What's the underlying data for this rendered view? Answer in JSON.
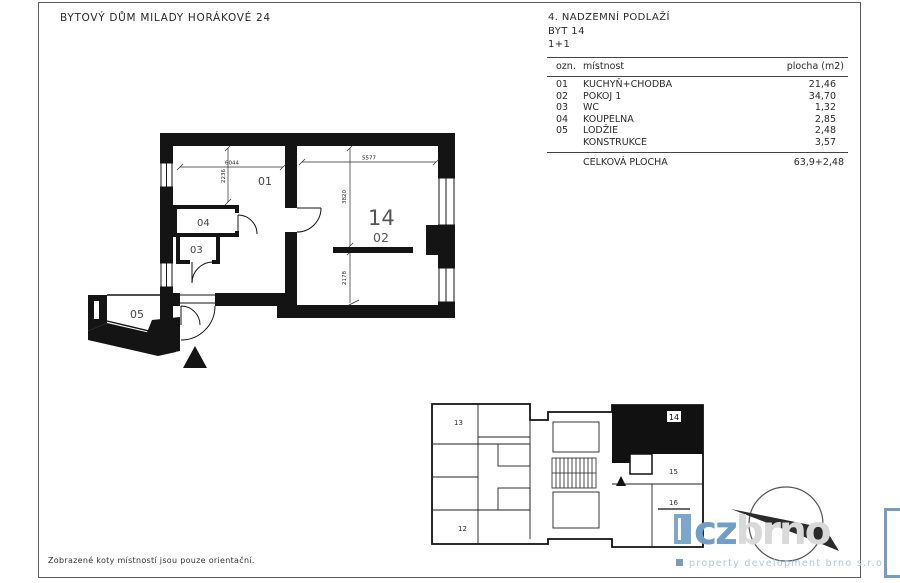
{
  "sheet": {
    "title": "BYTOVÝ DŮM MILADY HORÁKOVÉ 24",
    "note": "Zobrazené koty místností jsou pouze orientační."
  },
  "header": {
    "floor": "4. NADZEMNÍ PODLAŽÍ",
    "unit": "BYT 14",
    "disposition": "1+1"
  },
  "area_table": {
    "col_ozn": "ozn.",
    "col_room": "místnost",
    "col_area": "plocha (m2)",
    "rows": [
      {
        "ozn": "01",
        "room": "KUCHYŇ+CHODBA",
        "area": "21,46"
      },
      {
        "ozn": "02",
        "room": "POKOJ 1",
        "area": "34,70"
      },
      {
        "ozn": "03",
        "room": "WC",
        "area": "1,32"
      },
      {
        "ozn": "04",
        "room": "KOUPELNA",
        "area": "2,85"
      },
      {
        "ozn": "05",
        "room": "LODŽIE",
        "area": "2,48"
      },
      {
        "ozn": "",
        "room": "KONSTRUKCE",
        "area": "3,57"
      }
    ],
    "total_label": "CELKOVÁ PLOCHA",
    "total_value": "63,9+2,48"
  },
  "plan": {
    "apt_number": "14",
    "rooms": {
      "r01": "01",
      "r02": "02",
      "r03": "03",
      "r04": "04",
      "r05": "05"
    },
    "dims": {
      "room01_width": "6044",
      "room01_depth": "2236",
      "room02_width": "5577",
      "room02_depth_upper": "3820",
      "room02_depth_lower": "2178"
    }
  },
  "overview": {
    "apt12": "12",
    "apt13": "13",
    "apt14": "14",
    "apt15": "15",
    "apt16": "16"
  },
  "logo": {
    "cz": "cz",
    "brno": "brno",
    "tagline": "property development brno s.r.o.",
    "accent_blue": "#6f9dc6",
    "light_gray": "#d9d9d9",
    "tagline_blue": "#abc8e2",
    "bullet_blue": "#7e9cba"
  }
}
